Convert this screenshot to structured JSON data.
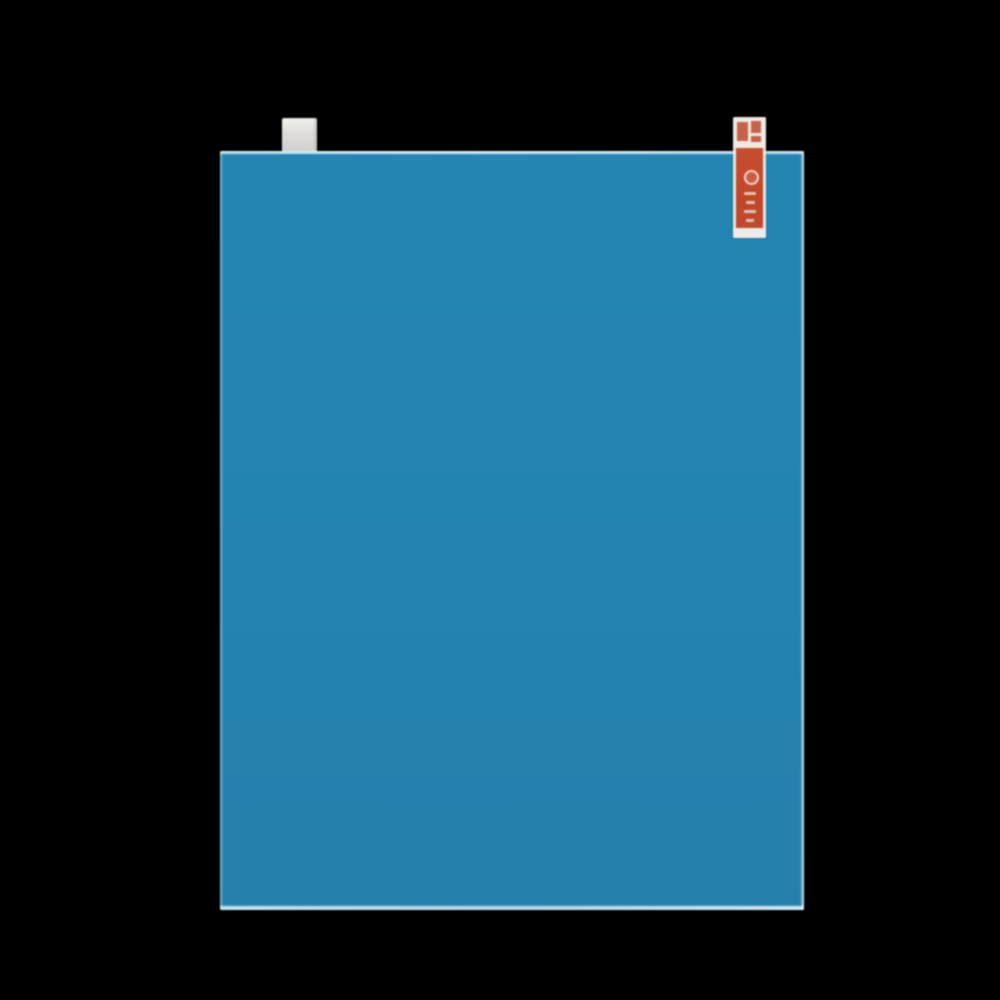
{
  "scene": {
    "type": "product photo",
    "subject": "Blue screen protector film with application pull tabs on a black background",
    "background_color": "#000000"
  },
  "film": {
    "label": "screen protector film sheet",
    "color": "#2483af",
    "edge_highlight_color": "#d6f0fa"
  },
  "gray_tab": {
    "label": "gray backing pull tab",
    "color": "#dddcd8"
  },
  "red_sticker": {
    "label": "red printed pull-tab sticker with illegible vertical print",
    "red_color": "#c04728",
    "backing_color": "#f3f0ea",
    "print_color": "#ffffff"
  }
}
